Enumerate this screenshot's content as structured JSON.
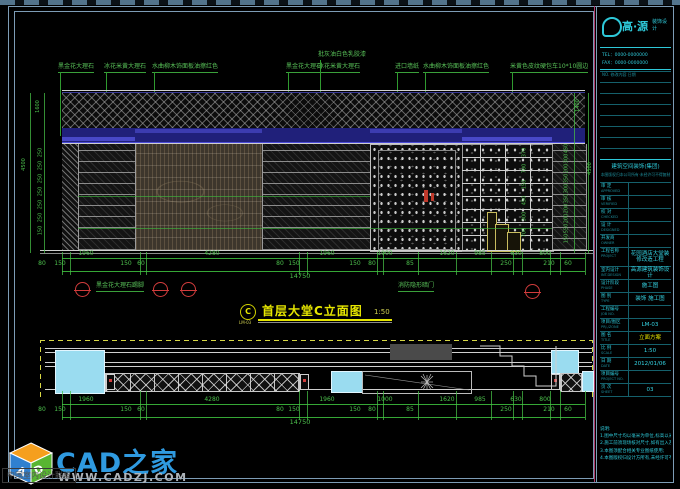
{
  "colors": {
    "frame": "#7d9cb5",
    "cad_green": "#58c058",
    "cyan": "#2ec8d8",
    "yellow": "#e6e600",
    "red": "#d23c3c",
    "plan_cyan": "#9adcf0",
    "brand_blue": "#2f9ae0"
  },
  "materials": [
    "黑金花大理石",
    "冰花米黄大理石",
    "水曲柳木饰面板油擦红色",
    "黑金花大理石",
    "批灰油白色乳胶漆",
    "冰花米黄大理石",
    "进口墙纸",
    "水曲柳木饰面板油擦红色",
    "米黄色皮纹硬包车10*10圆边"
  ],
  "elevation": {
    "title": "首层大堂C立面图",
    "scale": "1:50",
    "marker": "C",
    "marker_sheet": "LM-03",
    "skirting": "黑金花大理石踢脚",
    "hidden_door": "消防隐形暗门",
    "dims_major": [
      "1960",
      "4280",
      "1960",
      "1000",
      "1620",
      "985",
      "630",
      "800"
    ],
    "dims_minor": [
      "80",
      "150",
      "150",
      "60",
      "80",
      "150",
      "150",
      "80",
      "85",
      "250",
      "210",
      "60"
    ],
    "total": "14750",
    "left_total": "4500",
    "left_top": "1600",
    "left_chain": [
      "250",
      "250",
      "250",
      "250",
      "250",
      "250",
      "150"
    ],
    "right_total": "4500",
    "right_top": "1400",
    "right_chain": [
      "450",
      "300",
      "200",
      "350",
      "300",
      "350",
      "200",
      "200",
      "550",
      "150"
    ],
    "inner_chain": [
      "370",
      "700",
      "150",
      "450",
      "300",
      "700"
    ]
  },
  "plan": {
    "dims_major": [
      "1960",
      "4280",
      "1960",
      "1000",
      "1620",
      "985",
      "630",
      "800"
    ],
    "dims_minor": [
      "80",
      "150",
      "150",
      "60",
      "80",
      "150",
      "150",
      "80",
      "85",
      "250",
      "210",
      "60"
    ],
    "total": "14750"
  },
  "titleblock": {
    "logo_name": "高·源",
    "logo_sub": "装饰设计",
    "tel": "TEL：0000-0000000",
    "fax": "FAX：0000-0000000",
    "rev_header": "NO.  修改内容  日期",
    "org": "建筑空间装饰(集团)",
    "copyright": "本图版权归本公司所有·未经许可不得复制",
    "fields": [
      {
        "label": "审 定",
        "en": "APPROVED",
        "value": ""
      },
      {
        "label": "审 核",
        "en": "VERIFIED",
        "value": ""
      },
      {
        "label": "校 对",
        "en": "CHECKED",
        "value": ""
      },
      {
        "label": "设 计",
        "en": "DESIGNED",
        "value": ""
      },
      {
        "label": "开发商",
        "en": "OWNER",
        "value": ""
      },
      {
        "label": "工程名称",
        "en": "PROJECT",
        "value": "花园酒店大堂装修改造工程",
        "tall": true
      },
      {
        "label": "室内设计",
        "en": "INT.DESIGN",
        "value": "高源建筑装饰设计"
      },
      {
        "label": "设计阶段",
        "en": "PHASE",
        "value": "施工图"
      },
      {
        "label": "图 别",
        "en": "TYPE",
        "value": "装饰 施工图"
      },
      {
        "label": "工程编号",
        "en": "JOB NO.",
        "value": ""
      },
      {
        "label": "项目/图区",
        "en": "PRJ./ZONE",
        "value": "LM-03"
      },
      {
        "label": "图 名",
        "en": "TITLE",
        "value": "立面方案",
        "accent": true
      },
      {
        "label": "比 例",
        "en": "SCALE",
        "value": "1:50"
      },
      {
        "label": "日 期",
        "en": "DATE",
        "value": "2012/01/06"
      },
      {
        "label": "项目编号",
        "en": "PROJECT NO.",
        "value": ""
      },
      {
        "label": "页 次",
        "en": "SHEET",
        "value": "03"
      }
    ],
    "notes": [
      "说明:",
      "1.图中尺寸均以毫米为单位,标高以米为单位;",
      "2.施工前须现场核对尺寸,如有出入及时通知设计师;",
      "3.本图须配合相关专业图纸使用;",
      "4.本图版权归设计方所有,未经许可不得复制转用。"
    ]
  },
  "watermark": {
    "brand": "CAD之家",
    "url": "WWW.CADZJ.COM",
    "badge": "中国室内设计联盟",
    "cube_letters": [
      "A",
      "D"
    ]
  }
}
